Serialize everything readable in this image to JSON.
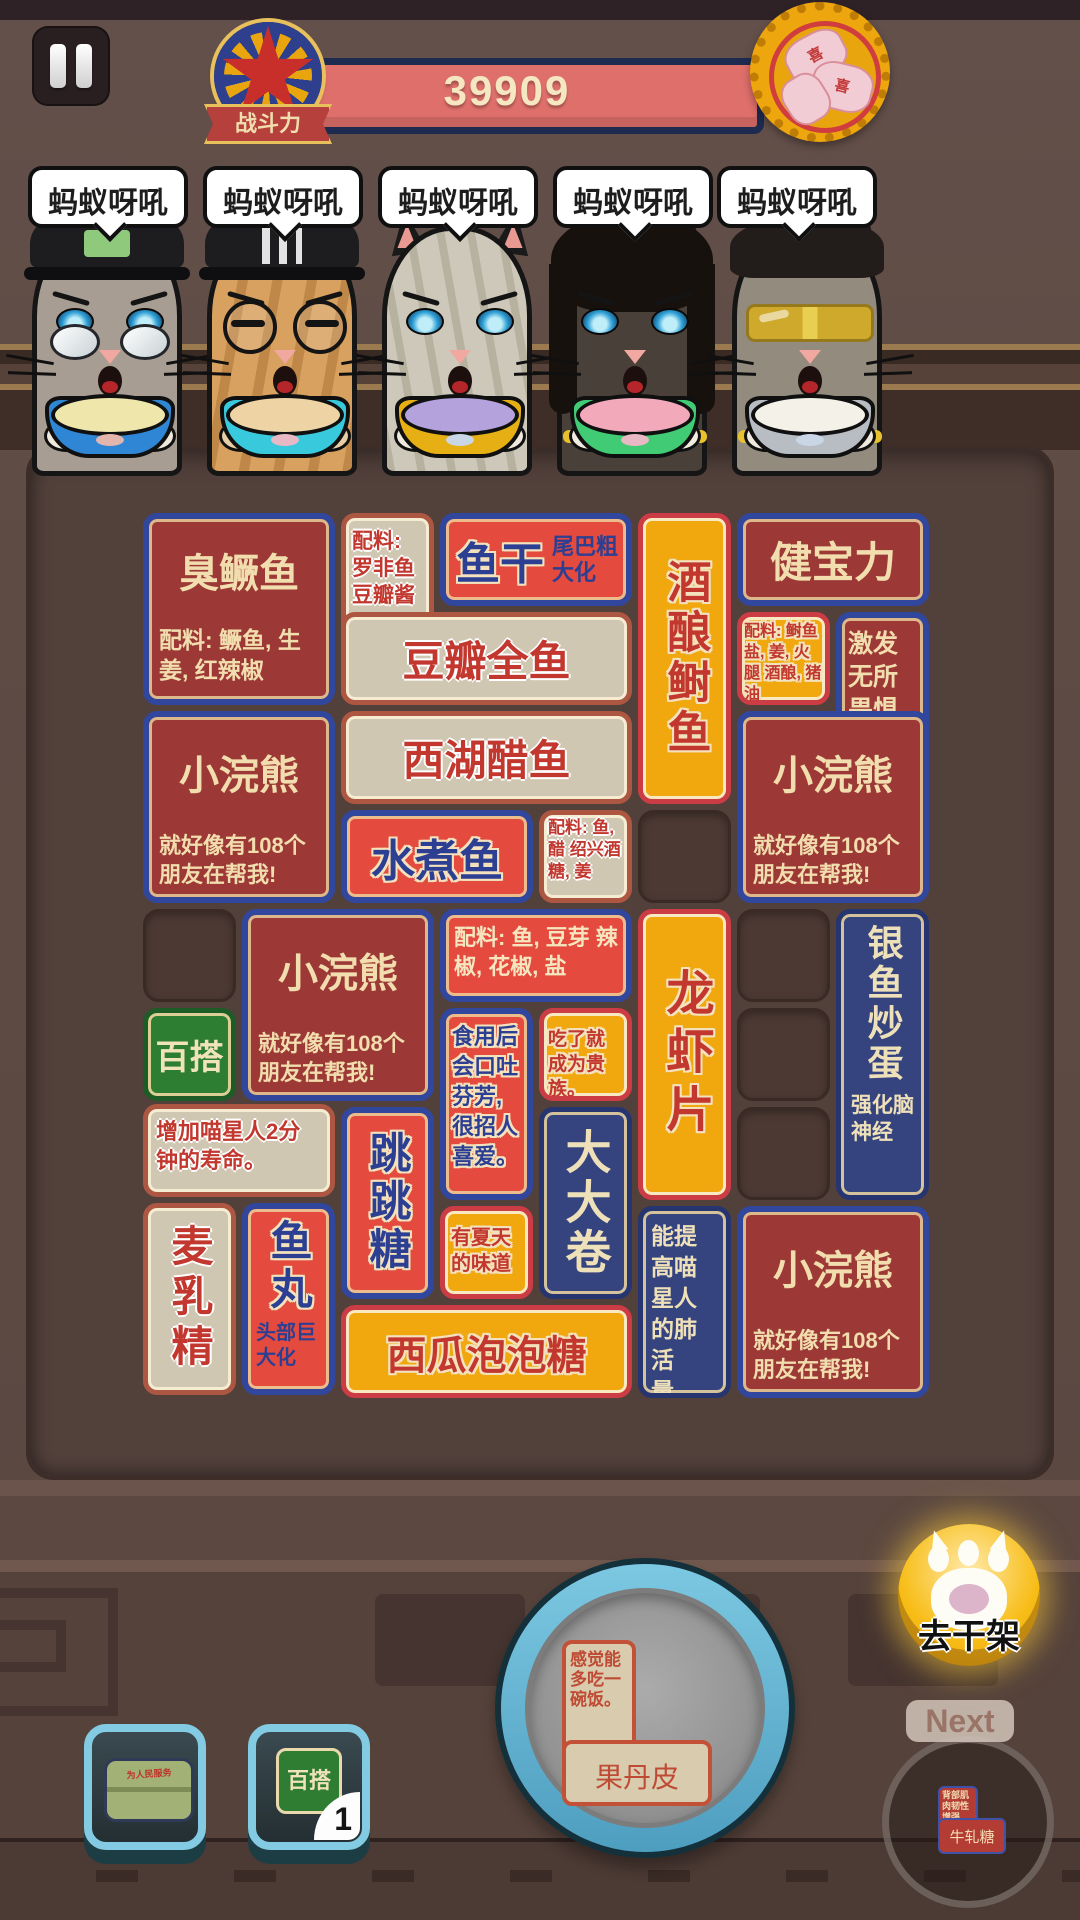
{
  "header": {
    "power_label": "战斗力",
    "power_value": "39909",
    "lucky_badge_char": "喜"
  },
  "cats": {
    "bubble_text": "蚂蚁呀吼"
  },
  "board": {
    "tiles": {
      "stinky_fish": {
        "name": "臭鳜鱼",
        "desc": "配料: 鳜鱼, 生姜, 红辣椒"
      },
      "fish_jerky": {
        "name": "鱼干",
        "desc": "尾巴粗大化"
      },
      "douban_fish": {
        "name": "豆瓣全鱼",
        "desc": "配料: 罗非鱼 豆瓣酱"
      },
      "jiuniang_shad": {
        "name": "酒酿鲥鱼",
        "desc": "配料: 鲥鱼 盐, 姜, 火腿 酒酿, 猪油"
      },
      "jianbaoli": {
        "name": "健宝力",
        "desc": "激发无所畏惧状态"
      },
      "raccoon": {
        "name": "小浣熊",
        "desc": "就好像有108个朋友在帮我!"
      },
      "westlake_fish": {
        "name": "西湖醋鱼",
        "desc": "配料: 鱼, 醋 绍兴酒 糖, 姜"
      },
      "boiled_fish": {
        "name": "水煮鱼",
        "desc": "配料: 鱼, 豆芽 辣椒, 花椒, 盐"
      },
      "wildcard": {
        "name": "百搭"
      },
      "malted_milk": {
        "name": "麦乳精",
        "desc": "增加喵星人2分钟的寿命。"
      },
      "fish_ball": {
        "name": "鱼丸",
        "desc": "头部巨大化"
      },
      "popping_candy": {
        "name": "跳跳糖",
        "desc": "食用后会口吐芬芳, 很招人喜爱。"
      },
      "watermelon_gum": {
        "name": "西瓜泡泡糖",
        "desc": "有夏天的味道"
      },
      "dadajuan": {
        "name": "大大卷",
        "desc": "能提高喵星人的肺活量。"
      },
      "prawn_cracker": {
        "name": "龙虾片",
        "desc": "吃了就成为贵族。"
      },
      "silverfish_egg": {
        "name": "银鱼炒蛋",
        "desc": "强化脑神经"
      }
    }
  },
  "bottom": {
    "plate_tile": {
      "name": "果丹皮",
      "desc": "感觉能多吃一碗饭。"
    },
    "fight_button": "去干架",
    "next_label": "Next",
    "next_tile": {
      "name": "牛轧糖",
      "desc": "背部肌肉韧性增强"
    },
    "wildcard_item": {
      "label": "百搭",
      "count": "1"
    },
    "bag_item": {
      "label": "为人民服务"
    }
  },
  "colors": {
    "power_bar": "#de6f6a",
    "tile_dark_red": "#9c3936",
    "tile_red": "#e44a3e",
    "tile_beige": "#cfc7b1",
    "tile_yellow": "#f0a80e",
    "tile_blue": "#35447f",
    "tile_green": "#2d7e33",
    "board_panel": "#52403b",
    "fight_button": "#f7bd17"
  }
}
